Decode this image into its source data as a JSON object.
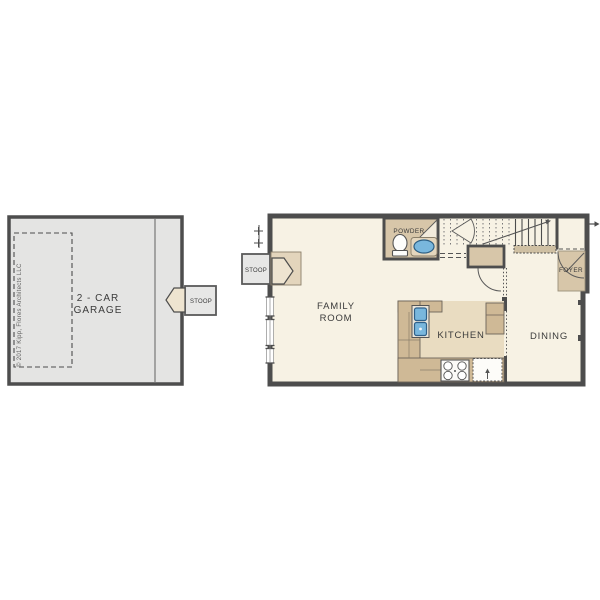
{
  "copyright": "© 2017 Kipp, Flores Architects LLC",
  "garage": {
    "label_line1": "2 - CAR",
    "label_line2": "GARAGE",
    "stoop_label": "STOOP"
  },
  "main_floor": {
    "stoop_label": "STOOP",
    "family_room_line1": "FAMILY",
    "family_room_line2": "ROOM",
    "powder_label": "POWDER",
    "kitchen_label": "KITCHEN",
    "dining_label": "DINING",
    "foyer_label": "FOYER"
  },
  "colors": {
    "wall": "#4d4d4d",
    "garage_floor": "#e4e4e3",
    "main_floor_fill": "#f7f2e4",
    "tan_room": "#d7c6a9",
    "counter": "#cfb996",
    "kitchen_floor": "#e9dcc1",
    "sink_blue": "#79b7dd",
    "stoop_fill": "#e7e7e6",
    "door_fill": "#eee4d0",
    "label_text": "#3b3b3b"
  }
}
